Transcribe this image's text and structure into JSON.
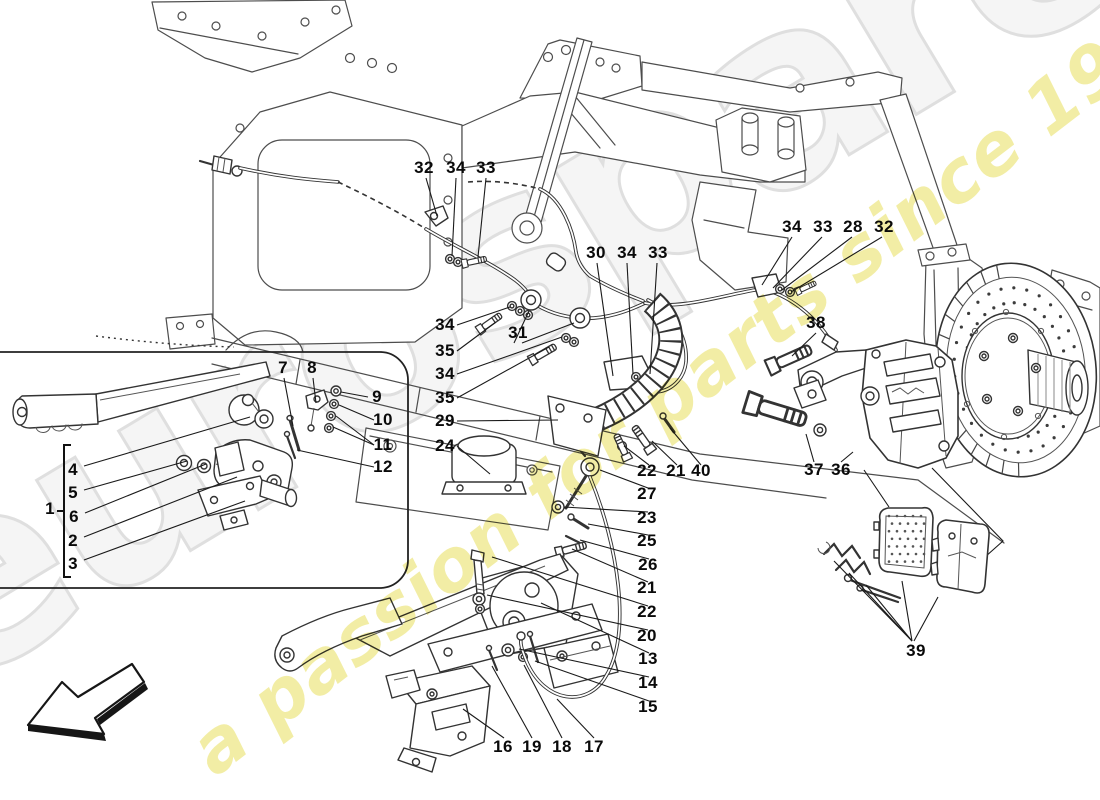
{
  "watermark": {
    "brand": "eurospares",
    "tagline": "a passion for parts since 1985",
    "brand_color": "#f5f5f5",
    "tagline_color": "#efe88f"
  },
  "callout_labels": [
    {
      "t": "32",
      "x": 424,
      "y": 168
    },
    {
      "t": "34",
      "x": 456,
      "y": 168
    },
    {
      "t": "33",
      "x": 486,
      "y": 168
    },
    {
      "t": "30",
      "x": 596,
      "y": 253
    },
    {
      "t": "34",
      "x": 627,
      "y": 253
    },
    {
      "t": "33",
      "x": 658,
      "y": 253
    },
    {
      "t": "34",
      "x": 792,
      "y": 227
    },
    {
      "t": "33",
      "x": 823,
      "y": 227
    },
    {
      "t": "28",
      "x": 853,
      "y": 227
    },
    {
      "t": "32",
      "x": 884,
      "y": 227
    },
    {
      "t": "38",
      "x": 816,
      "y": 323
    },
    {
      "t": "34",
      "x": 445,
      "y": 325
    },
    {
      "t": "35",
      "x": 445,
      "y": 351
    },
    {
      "t": "34",
      "x": 445,
      "y": 374
    },
    {
      "t": "35",
      "x": 445,
      "y": 398
    },
    {
      "t": "29",
      "x": 445,
      "y": 421
    },
    {
      "t": "24",
      "x": 445,
      "y": 446
    },
    {
      "t": "31",
      "x": 518,
      "y": 333
    },
    {
      "t": "7",
      "x": 283,
      "y": 368
    },
    {
      "t": "8",
      "x": 312,
      "y": 368
    },
    {
      "t": "9",
      "x": 377,
      "y": 397
    },
    {
      "t": "10",
      "x": 383,
      "y": 420
    },
    {
      "t": "11",
      "x": 383,
      "y": 445
    },
    {
      "t": "12",
      "x": 383,
      "y": 467
    },
    {
      "t": "1",
      "x": 50,
      "y": 509
    },
    {
      "t": "4",
      "x": 73,
      "y": 470
    },
    {
      "t": "5",
      "x": 73,
      "y": 493
    },
    {
      "t": "6",
      "x": 74,
      "y": 517
    },
    {
      "t": "2",
      "x": 73,
      "y": 541
    },
    {
      "t": "3",
      "x": 73,
      "y": 564
    },
    {
      "t": "22",
      "x": 647,
      "y": 471
    },
    {
      "t": "21",
      "x": 676,
      "y": 471
    },
    {
      "t": "40",
      "x": 701,
      "y": 471
    },
    {
      "t": "27",
      "x": 647,
      "y": 494
    },
    {
      "t": "23",
      "x": 647,
      "y": 518
    },
    {
      "t": "25",
      "x": 647,
      "y": 541
    },
    {
      "t": "26",
      "x": 648,
      "y": 565
    },
    {
      "t": "21",
      "x": 647,
      "y": 588
    },
    {
      "t": "22",
      "x": 647,
      "y": 612
    },
    {
      "t": "20",
      "x": 647,
      "y": 636
    },
    {
      "t": "13",
      "x": 648,
      "y": 659
    },
    {
      "t": "14",
      "x": 648,
      "y": 683
    },
    {
      "t": "15",
      "x": 648,
      "y": 707
    },
    {
      "t": "37",
      "x": 814,
      "y": 470
    },
    {
      "t": "36",
      "x": 841,
      "y": 470
    },
    {
      "t": "39",
      "x": 916,
      "y": 651
    },
    {
      "t": "16",
      "x": 503,
      "y": 747
    },
    {
      "t": "19",
      "x": 532,
      "y": 747
    },
    {
      "t": "18",
      "x": 562,
      "y": 747
    },
    {
      "t": "17",
      "x": 594,
      "y": 747
    }
  ]
}
